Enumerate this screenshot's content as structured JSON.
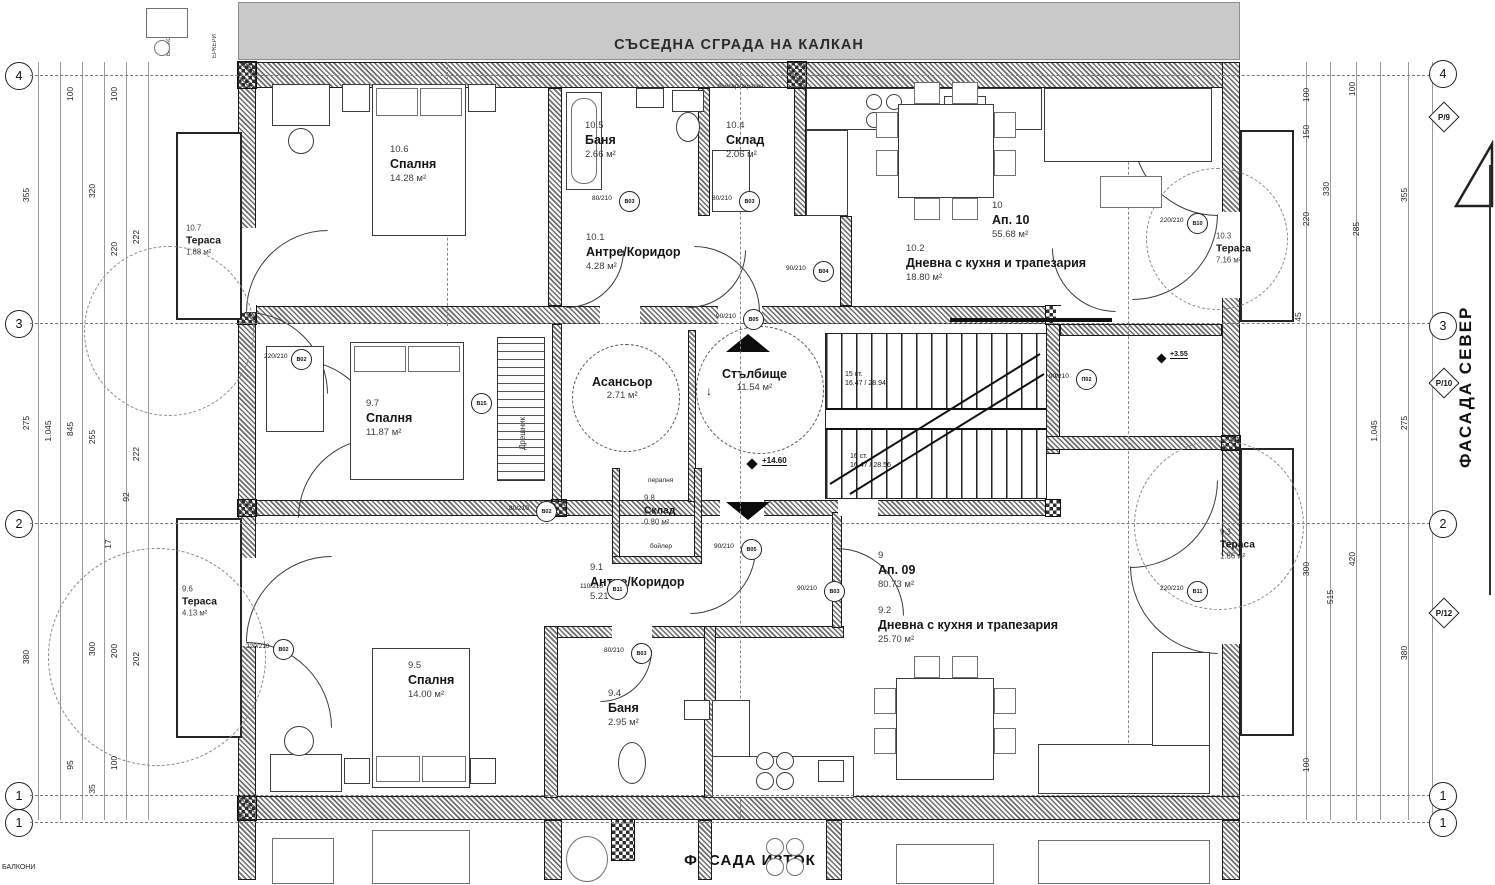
{
  "banner": {
    "text": "СЪСЕДНА СГРАДА НА КАЛКАН"
  },
  "facades": {
    "right": "ФАСАДА СЕВЕР",
    "bottom": "ФАСАДА ИЗТОК"
  },
  "corner_labels": {
    "top_left_1": "БАЛКОНИ",
    "top_left_2": "ЕРКЕРИ",
    "bottom_left": "БАЛКОНИ"
  },
  "apartments": [
    {
      "num": "10",
      "name": "Ап. 10",
      "area": "55.68 м²",
      "x": 992,
      "y": 200
    },
    {
      "num": "9",
      "name": "Ап. 09",
      "area": "80.73 м²",
      "x": 878,
      "y": 550
    }
  ],
  "rooms": [
    {
      "num": "10.6",
      "name": "Спалня",
      "area": "14.28 м²",
      "x": 390,
      "y": 144
    },
    {
      "num": "10.7",
      "name": "Тераса",
      "area": "1.88 м²",
      "x": 186,
      "y": 224,
      "size": "s"
    },
    {
      "num": "10.5",
      "name": "Баня",
      "area": "2.66 м²",
      "x": 585,
      "y": 120
    },
    {
      "num": "10.4",
      "name": "Склад",
      "area": "2.06 м²",
      "x": 726,
      "y": 120
    },
    {
      "num": "10.1",
      "name": "Антре/Коридор",
      "area": "4.28 м²",
      "x": 586,
      "y": 232
    },
    {
      "num": "10.2",
      "name": "Дневна с кухня и трапезария",
      "area": "18.80 м²",
      "x": 906,
      "y": 243
    },
    {
      "num": "10.3",
      "name": "Тераса",
      "area": "7.16 м²",
      "x": 1216,
      "y": 232,
      "size": "s"
    },
    {
      "num": "9.7",
      "name": "Спалня",
      "area": "11.87 м²",
      "x": 366,
      "y": 398
    },
    {
      "num": "9.8",
      "name": "Склад",
      "area": "0.80 м²",
      "x": 644,
      "y": 494,
      "size": "s"
    },
    {
      "num": "9.1",
      "name": "Антре/Коридор",
      "area": "5.21 м²",
      "x": 590,
      "y": 562
    },
    {
      "num": "9.2",
      "name": "Дневна с кухня и трапезария",
      "area": "25.70 м²",
      "x": 878,
      "y": 605
    },
    {
      "num": "9.6",
      "name": "Тераса",
      "area": "4.13 м²",
      "x": 182,
      "y": 585,
      "size": "s"
    },
    {
      "num": "9.5",
      "name": "Спалня",
      "area": "14.00 м²",
      "x": 408,
      "y": 660
    },
    {
      "num": "9.4",
      "name": "Баня",
      "area": "2.95 м²",
      "x": 608,
      "y": 688
    },
    {
      "num": "9.3",
      "name": "Тераса",
      "area": "1.86 м²",
      "x": 1220,
      "y": 528,
      "size": "s"
    }
  ],
  "core": {
    "lift": {
      "name": "Асансьор",
      "area": "2.71 м²"
    },
    "stair": {
      "name": "Стълбище",
      "area": "11.54 м²",
      "down_arrow": "↓"
    },
    "flight_top": "15 ст.\n16.47 / 28.94",
    "flight_bottom": "16 ст.\n16.47 / 28.56",
    "elevation_main": "+14.60",
    "elevation_side": "+3.55",
    "washer": "пералня",
    "boiler": "бойлер",
    "appliances_top": "бойлер  пералня",
    "wardrobe": "Дрешник"
  },
  "grid": {
    "left": [
      {
        "n": "4",
        "y": 75
      },
      {
        "n": "3",
        "y": 323
      },
      {
        "n": "2",
        "y": 523
      },
      {
        "n": "1",
        "y": 795
      },
      {
        "n": "1",
        "y": 822
      }
    ],
    "right": [
      {
        "n": "4",
        "y": 73
      },
      {
        "n": "3",
        "y": 325
      },
      {
        "n": "2",
        "y": 523
      },
      {
        "n": "1",
        "y": 795
      },
      {
        "n": "1",
        "y": 822
      }
    ],
    "pentagons": [
      {
        "n": "Р/9",
        "y": 117
      },
      {
        "n": "Р/10",
        "y": 383
      },
      {
        "n": "Р/12",
        "y": 613
      }
    ]
  },
  "dimensions": {
    "left": [
      {
        "v": "100",
        "x": 70,
        "y": 95
      },
      {
        "v": "100",
        "x": 114,
        "y": 95
      },
      {
        "v": "355",
        "x": 26,
        "y": 196
      },
      {
        "v": "320",
        "x": 92,
        "y": 192
      },
      {
        "v": "220",
        "x": 114,
        "y": 250
      },
      {
        "v": "222",
        "x": 136,
        "y": 238
      },
      {
        "v": "275",
        "x": 26,
        "y": 424
      },
      {
        "v": "1.045",
        "x": 48,
        "y": 432
      },
      {
        "v": "845",
        "x": 70,
        "y": 430
      },
      {
        "v": "255",
        "x": 92,
        "y": 438
      },
      {
        "v": "222",
        "x": 136,
        "y": 455
      },
      {
        "v": "92",
        "x": 126,
        "y": 498
      },
      {
        "v": "17",
        "x": 108,
        "y": 545
      },
      {
        "v": "380",
        "x": 26,
        "y": 658
      },
      {
        "v": "300",
        "x": 92,
        "y": 650
      },
      {
        "v": "200",
        "x": 114,
        "y": 652
      },
      {
        "v": "202",
        "x": 136,
        "y": 660
      },
      {
        "v": "95",
        "x": 70,
        "y": 766
      },
      {
        "v": "100",
        "x": 114,
        "y": 764
      },
      {
        "v": "35",
        "x": 92,
        "y": 790
      }
    ],
    "right": [
      {
        "v": "100",
        "x": 1306,
        "y": 96
      },
      {
        "v": "100",
        "x": 1352,
        "y": 90
      },
      {
        "v": "150",
        "x": 1306,
        "y": 133
      },
      {
        "v": "355",
        "x": 1404,
        "y": 196
      },
      {
        "v": "330",
        "x": 1326,
        "y": 190
      },
      {
        "v": "285",
        "x": 1356,
        "y": 230
      },
      {
        "v": "220",
        "x": 1306,
        "y": 220
      },
      {
        "v": "45",
        "x": 1298,
        "y": 318
      },
      {
        "v": "275",
        "x": 1404,
        "y": 424
      },
      {
        "v": "1.045",
        "x": 1374,
        "y": 432
      },
      {
        "v": "420",
        "x": 1352,
        "y": 560
      },
      {
        "v": "515",
        "x": 1330,
        "y": 598
      },
      {
        "v": "300",
        "x": 1306,
        "y": 570
      },
      {
        "v": "380",
        "x": 1404,
        "y": 654
      },
      {
        "v": "100",
        "x": 1306,
        "y": 766
      }
    ]
  },
  "door_tags": [
    {
      "tag": "В03",
      "size": "80/210",
      "x": 628,
      "y": 200
    },
    {
      "tag": "В03",
      "size": "80/210",
      "x": 748,
      "y": 200
    },
    {
      "tag": "В04",
      "size": "90/210",
      "x": 822,
      "y": 270
    },
    {
      "tag": "В05",
      "size": "90/210",
      "x": 752,
      "y": 318
    },
    {
      "tag": "В02",
      "size": "220/210",
      "x": 300,
      "y": 358
    },
    {
      "tag": "В15",
      "size": "",
      "x": 480,
      "y": 402
    },
    {
      "tag": "В02",
      "size": "80/210",
      "x": 545,
      "y": 510
    },
    {
      "tag": "В05",
      "size": "90/210",
      "x": 750,
      "y": 548
    },
    {
      "tag": "В11",
      "size": "110/210",
      "x": 616,
      "y": 588
    },
    {
      "tag": "В03",
      "size": "90/210",
      "x": 833,
      "y": 590
    },
    {
      "tag": "В03",
      "size": "80/210",
      "x": 640,
      "y": 652
    },
    {
      "tag": "В10",
      "size": "220/210",
      "x": 1196,
      "y": 222
    },
    {
      "tag": "В11",
      "size": "220/210",
      "x": 1196,
      "y": 590
    },
    {
      "tag": "П02",
      "size": "90/210",
      "x": 1085,
      "y": 378
    },
    {
      "tag": "В02",
      "size": "220/210",
      "x": 282,
      "y": 648
    }
  ]
}
